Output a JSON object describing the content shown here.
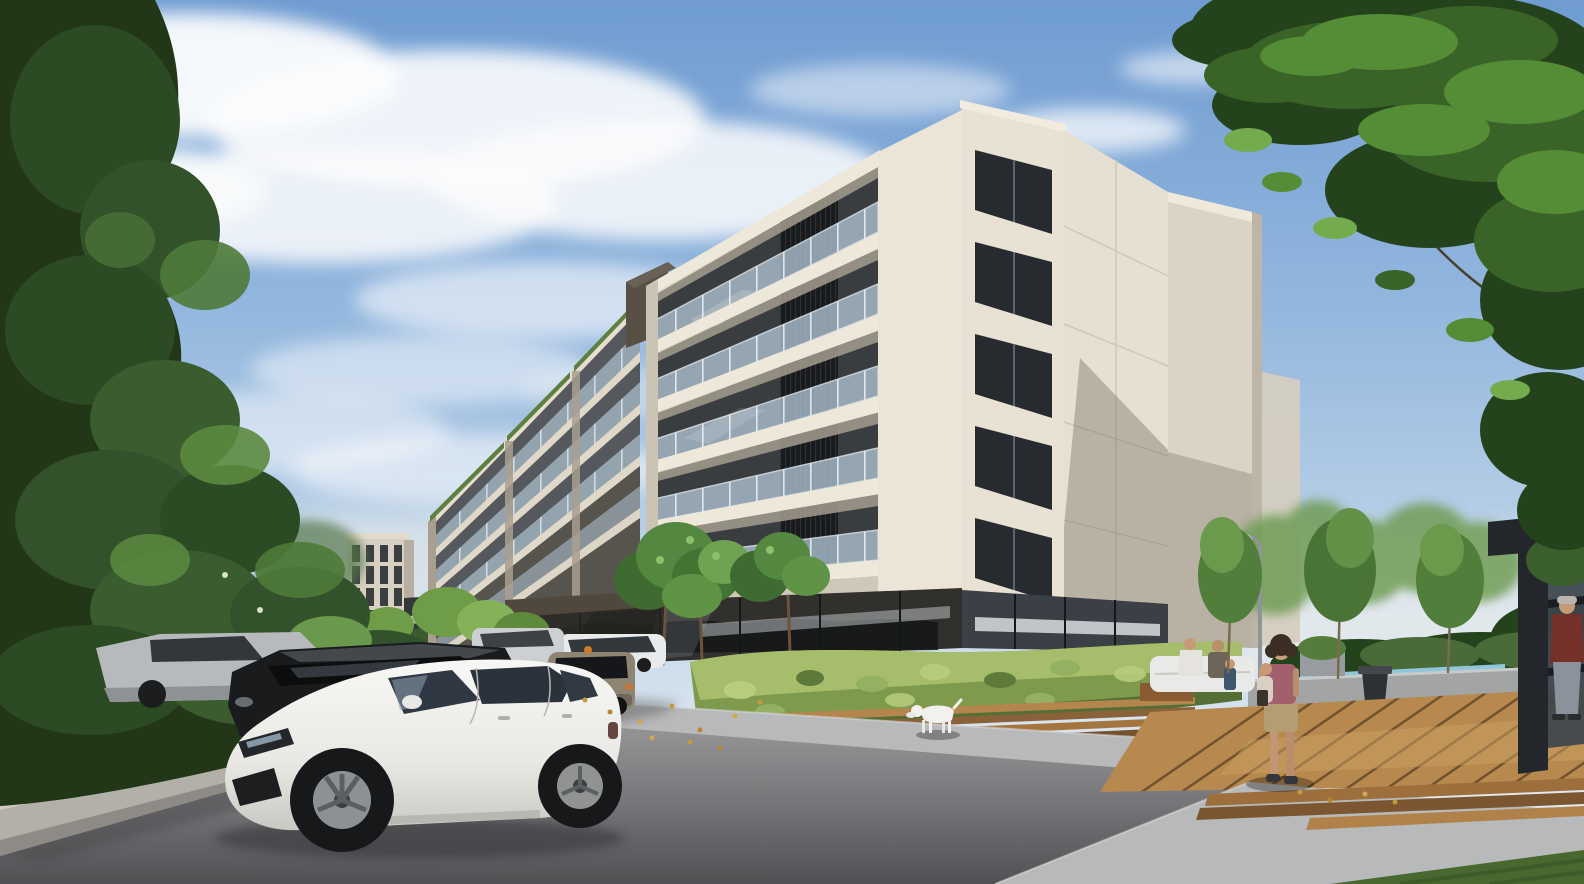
{
  "scene": {
    "type": "architectural-exterior-render",
    "time_of_day": "day",
    "description": "Photoreal daytime exterior rendering of a modern cream-colored six-storey apartment complex with stacked glass-railed balconies, dark vertical louver screens, a recessed dark glazed ground floor and stepped left wing blocks. A surface parking row fills the left foreground led by a white hatchback, with a black SUV, silver cars and a beige crossover behind. A lush hedge with timber bench slats lines the sidewalk where a white dog walks. On the right, a timber deck terrace with planters, a trash bin, a lounge seat, slender trees, a street lamp and a dark pergola with people. Tall green trees frame the top-left and top-right corners under a blue sky with soft clouds.",
    "objects": [
      "sky",
      "clouds",
      "distant-building",
      "apartment-building",
      "left-wing-blocks",
      "balconies",
      "glass-railings",
      "louver-screens",
      "corner-loggia-bays",
      "concrete-side-wall",
      "ground-floor-storefront",
      "entrance-canopy",
      "street-trees",
      "bright-shrubs",
      "front-hedge",
      "bench-slats",
      "street-lamp",
      "pool-edge",
      "planters",
      "trash-bin",
      "lounge-seat",
      "wooden-deck",
      "deck-edge-boards",
      "sidewalk",
      "grass",
      "road",
      "retaining-wall",
      "left-tree-mass",
      "right-tree-canopy",
      "parked-cars",
      "white-hatchback",
      "black-suv",
      "silver-sedan",
      "far-parked-cars",
      "beige-crossover",
      "background-suv",
      "white-dog",
      "woman-with-child",
      "man-in-pergola",
      "seated-people",
      "small-pedestrians",
      "fallen-leaves",
      "pergola"
    ]
  },
  "palette": {
    "sky_top": "#6f9cd1",
    "sky_horizon": "#e8eef3",
    "cloud": "#fbfcfd",
    "facade_light": "#ded6c6",
    "facade_pier": "#ece5d7",
    "facade_slab": "#eee8da",
    "side_wall_lit": "#e6e0d2",
    "rear_volume": "#dbd4c6",
    "window_dark": "#3a3d40",
    "louver_dark": "#181a1c",
    "balcony_glass": "#a9bdcb",
    "storefront_dark": "#32302c",
    "canopy_brown": "#50473d",
    "hedge_green": "#7e9a4c",
    "foliage_dark_left": "#223618",
    "foliage_dark_right": "#24421c",
    "deck_wood": "#b8894f",
    "bench_wood": "#b5854e",
    "sidewalk_gray": "#b8b9ba",
    "road_light": "#9b9b9d",
    "road_dark": "#515154",
    "grass_green": "#49682f",
    "retaining_wall": "#b3b0a9",
    "pool_water": "#8fc6da",
    "pergola_dark": "#23262a",
    "car_white": "#f1f1ee",
    "car_black": "#191b1d",
    "car_silver": "#b7babd",
    "car_beige": "#8d8472",
    "dog_white": "#f2f1ed",
    "shirt_red": "#76302a",
    "top_mauve": "#a2606c",
    "lamp_gray": "#90959a",
    "leaf_gold": "#c59a3e"
  }
}
